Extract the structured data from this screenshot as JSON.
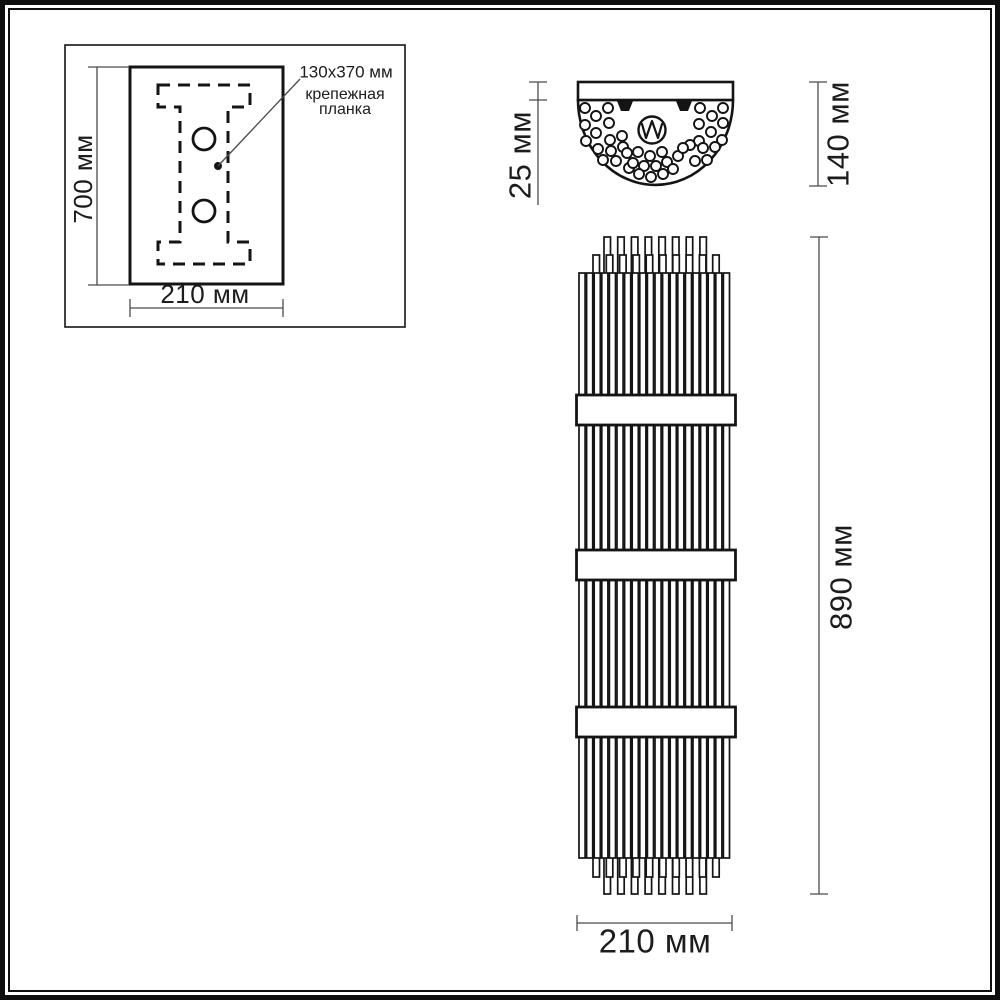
{
  "drawing": {
    "type": "wall-sconce technical drawing",
    "mounting_panel": {
      "height_label": "700 мм",
      "width_label": "210 мм",
      "plate_note_line1": "130x370 мм",
      "plate_note_line2": "крепежная",
      "plate_note_line3": "планка"
    },
    "top_view": {
      "plate_depth_label": "25 мм",
      "total_depth_label": "140 мм"
    },
    "front_view": {
      "height_label": "890 мм",
      "width_label": "210 мм"
    },
    "icons": {
      "lamp_symbol": "circle with W zigzag",
      "mount_clips": "two black trapezoid clips",
      "crystal_rods": "small circles scatter"
    },
    "colors": {
      "line": "#141414",
      "dim_line": "#4a4a4a",
      "text": "#1c1c1c",
      "background": "#ffffff"
    }
  }
}
